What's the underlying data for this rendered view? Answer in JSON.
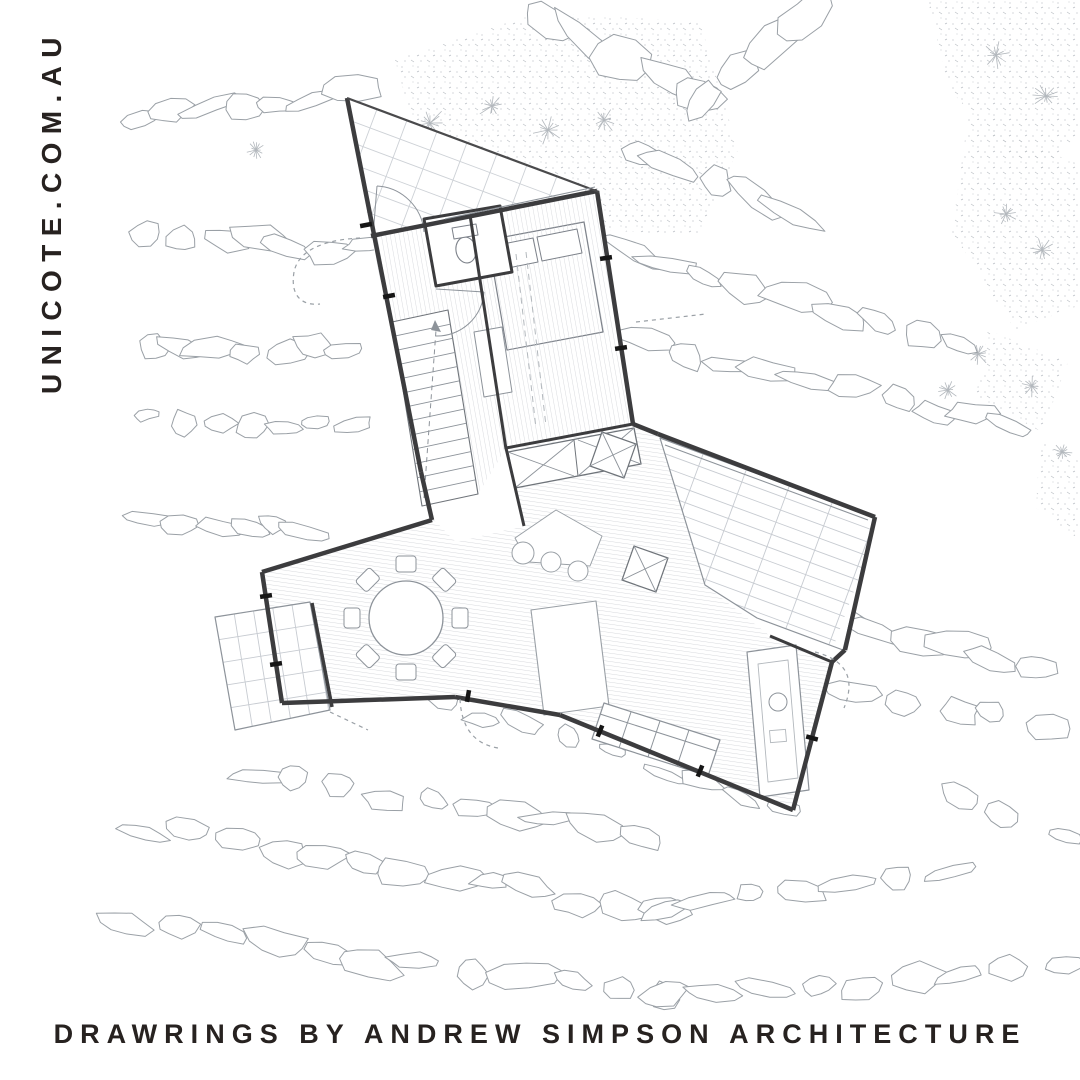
{
  "branding": {
    "side_text": "UNICOTE.COM.AU"
  },
  "caption": {
    "text": "DRAWRINGS BY ANDREW SIMPSON ARCHITECTURE"
  },
  "colors": {
    "background": "#ffffff",
    "text": "#272220",
    "wall": "#3c3c3e",
    "line_medium": "#8d939a",
    "line_light": "#a8adb3",
    "hatch": "#d8dade",
    "deck_grid": "#c7cbd1"
  },
  "drawing_layers": [
    "vegetation-stipple",
    "rock-contours",
    "floor-plan"
  ]
}
